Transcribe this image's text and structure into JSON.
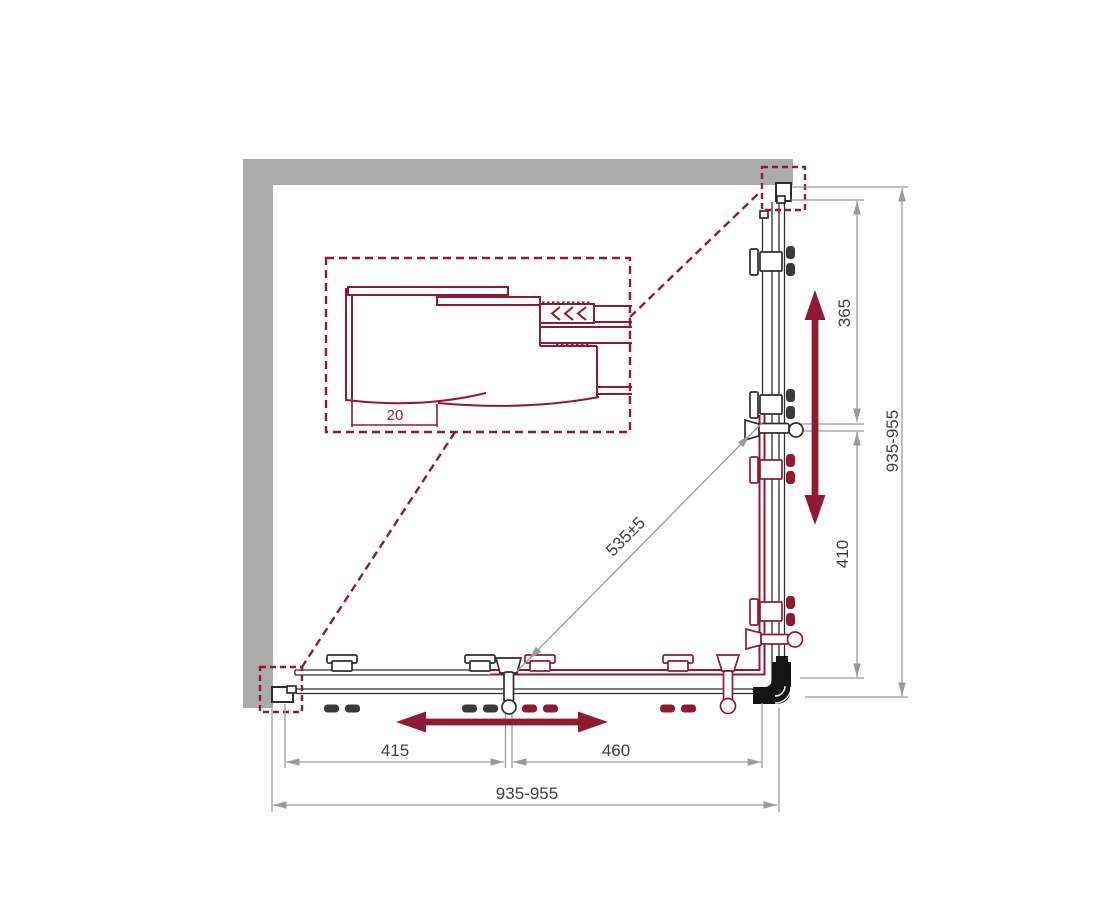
{
  "dimensions": {
    "total_width": "935-955",
    "total_height": "935-955",
    "left_segment": "415",
    "door_segment": "460",
    "upper_segment": "365",
    "lower_segment": "410",
    "diagonal_entry": "535±5",
    "profile_inset": "20"
  },
  "colors": {
    "accent": "#8e1b33",
    "wall": "#ababab",
    "dimension_lines": "#9b9b9b",
    "hardware": "#2e2e2e",
    "background": "#ffffff"
  }
}
